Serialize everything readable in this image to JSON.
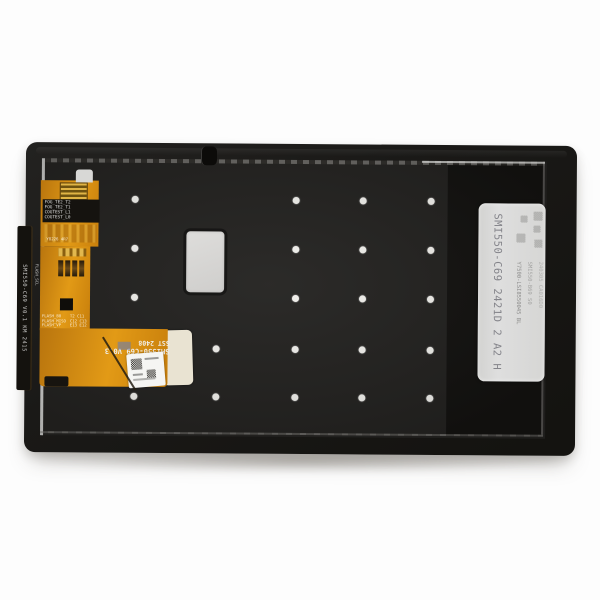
{
  "scene": {
    "background_color": "#fdfdfd"
  },
  "panel": {
    "colors": {
      "body": "#1b1a18",
      "inner": "#232220",
      "dark_zone": "#131210",
      "dot": "#f2f1ed",
      "cable_orange": "#d98c12",
      "label_gray": "#dbdbd9",
      "sticker_silver": "#d5d4d2",
      "pad_cream": "#e9e3d2"
    },
    "dots": [
      [
        134,
        200
      ],
      [
        295,
        200
      ],
      [
        362,
        200
      ],
      [
        430,
        200
      ],
      [
        134,
        249
      ],
      [
        295,
        249
      ],
      [
        362,
        249
      ],
      [
        430,
        249
      ],
      [
        134,
        298
      ],
      [
        295,
        298
      ],
      [
        362,
        298
      ],
      [
        430,
        298
      ],
      [
        134,
        349
      ],
      [
        216,
        349
      ],
      [
        295,
        349
      ],
      [
        362,
        349
      ],
      [
        430,
        349
      ],
      [
        134,
        397
      ],
      [
        216,
        397
      ],
      [
        295,
        397
      ],
      [
        362,
        397
      ],
      [
        430,
        397
      ]
    ]
  },
  "left_edge_label": {
    "text": "SMI550-C69 V0.1 KM 2415"
  },
  "cable": {
    "test_pad_labels": [
      "FOG_TE2_T2",
      "FOG_TE2_T1",
      "COGTEST_L1",
      "COGTEST_L0"
    ],
    "component_row_label": "Y8226 4R7",
    "vertical_trace_label": "FLASH_SCL",
    "left_pin_labels": [
      "FLASH_B0",
      "FLASH_MISO",
      "FLASH_VP"
    ],
    "right_pin_labels": [
      "T2 C11",
      "C12 C13",
      "E13 E12"
    ],
    "print_model": "SMI550-C69 V0.3",
    "print_batch": "SST 2408"
  },
  "right_label": {
    "main_code": "SMI550-C69  2421D  2  A2  H",
    "sub_code_1": "Y7500-LSI8550045 BL",
    "sub_code_2": "SMI550-B69 S0",
    "sub_code_3": "240305 CA016D0"
  }
}
